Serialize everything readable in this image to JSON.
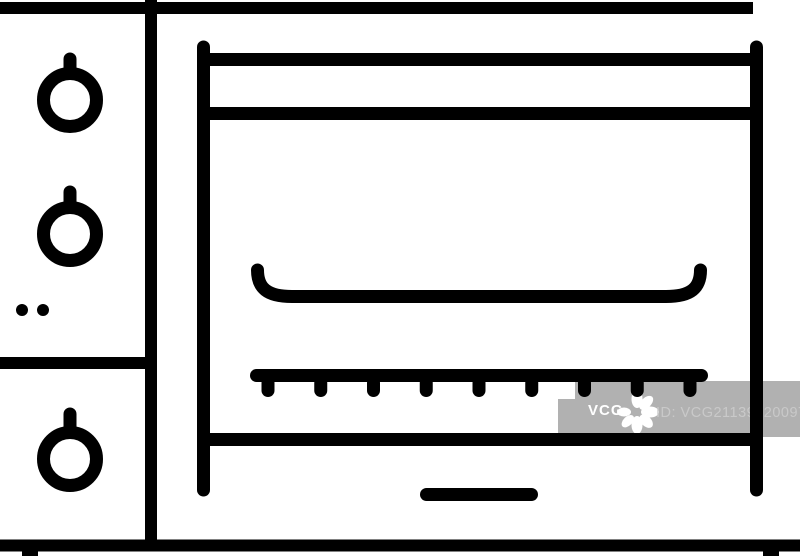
{
  "image": {
    "subject": "oven-stove-line-icon",
    "background_color": "#ffffff",
    "line_color": "#000000"
  },
  "watermark": {
    "logo_text": "VCG",
    "id_label": "ID: VCG211391200974",
    "badge_color": "#b1b1b1",
    "logo_text_color": "#ffffff",
    "id_text_color": "#c9c9c9"
  }
}
